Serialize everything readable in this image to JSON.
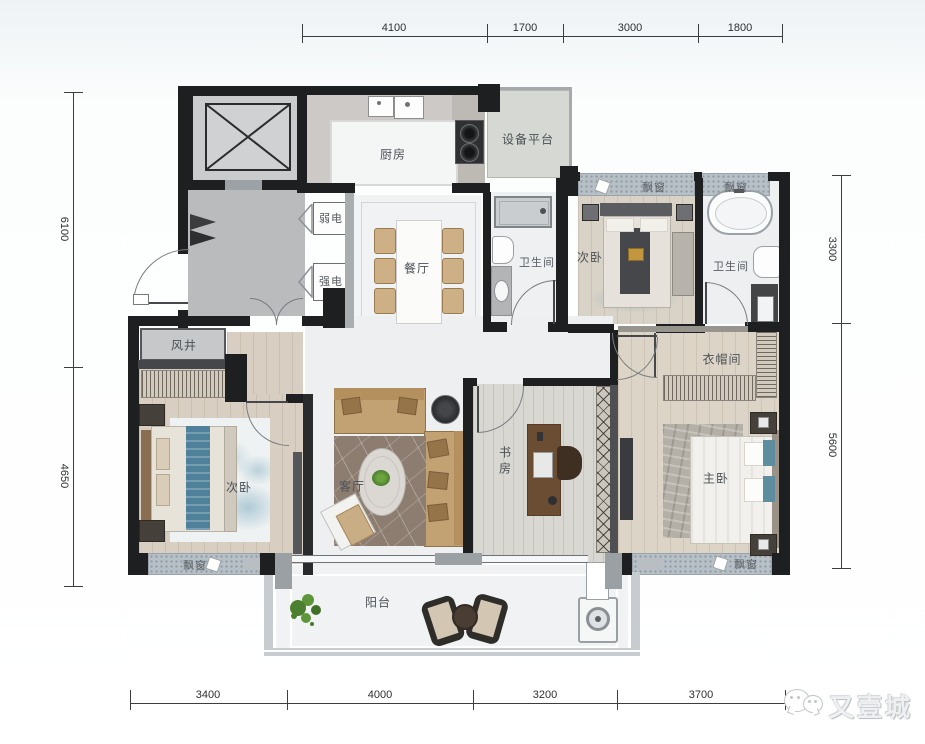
{
  "plan": {
    "rooms": {
      "kitchen": "厨房",
      "equipment_platform": "设备平台",
      "weak_current": "弱电",
      "strong_current": "强电",
      "dining_room": "餐厅",
      "bathroom_1": "卫生间",
      "bathroom_2": "卫生间",
      "bedroom_top": "次卧",
      "bedroom_left": "次卧",
      "wind_shaft": "风井",
      "living_room": "客厅",
      "study": "书房",
      "cloakroom": "衣帽间",
      "master_bedroom": "主卧",
      "balcony": "阳台",
      "bay_window": "飘窗"
    }
  },
  "dimensions": {
    "top": [
      "4100",
      "1700",
      "3000",
      "1800"
    ],
    "left": [
      "6100",
      "4650"
    ],
    "right": [
      "3300",
      "5600"
    ],
    "bottom": [
      "3400",
      "4000",
      "3200",
      "3700"
    ]
  },
  "watermark": {
    "brand": "又壹城",
    "icon": "wechat-bubbles-icon"
  },
  "colors": {
    "wall": "#1e1f21",
    "marble_floor": "#edeff1",
    "wood_floor": "#d8cfc2",
    "lobby_gray": "#b9bbbd",
    "bay_window_band": "#b8c0c7",
    "accent_tan": "#c2a172",
    "accent_teal": "#5e8da0",
    "rug_brown": "#8d7d70",
    "watermark_gray": "#c3c7cb"
  }
}
